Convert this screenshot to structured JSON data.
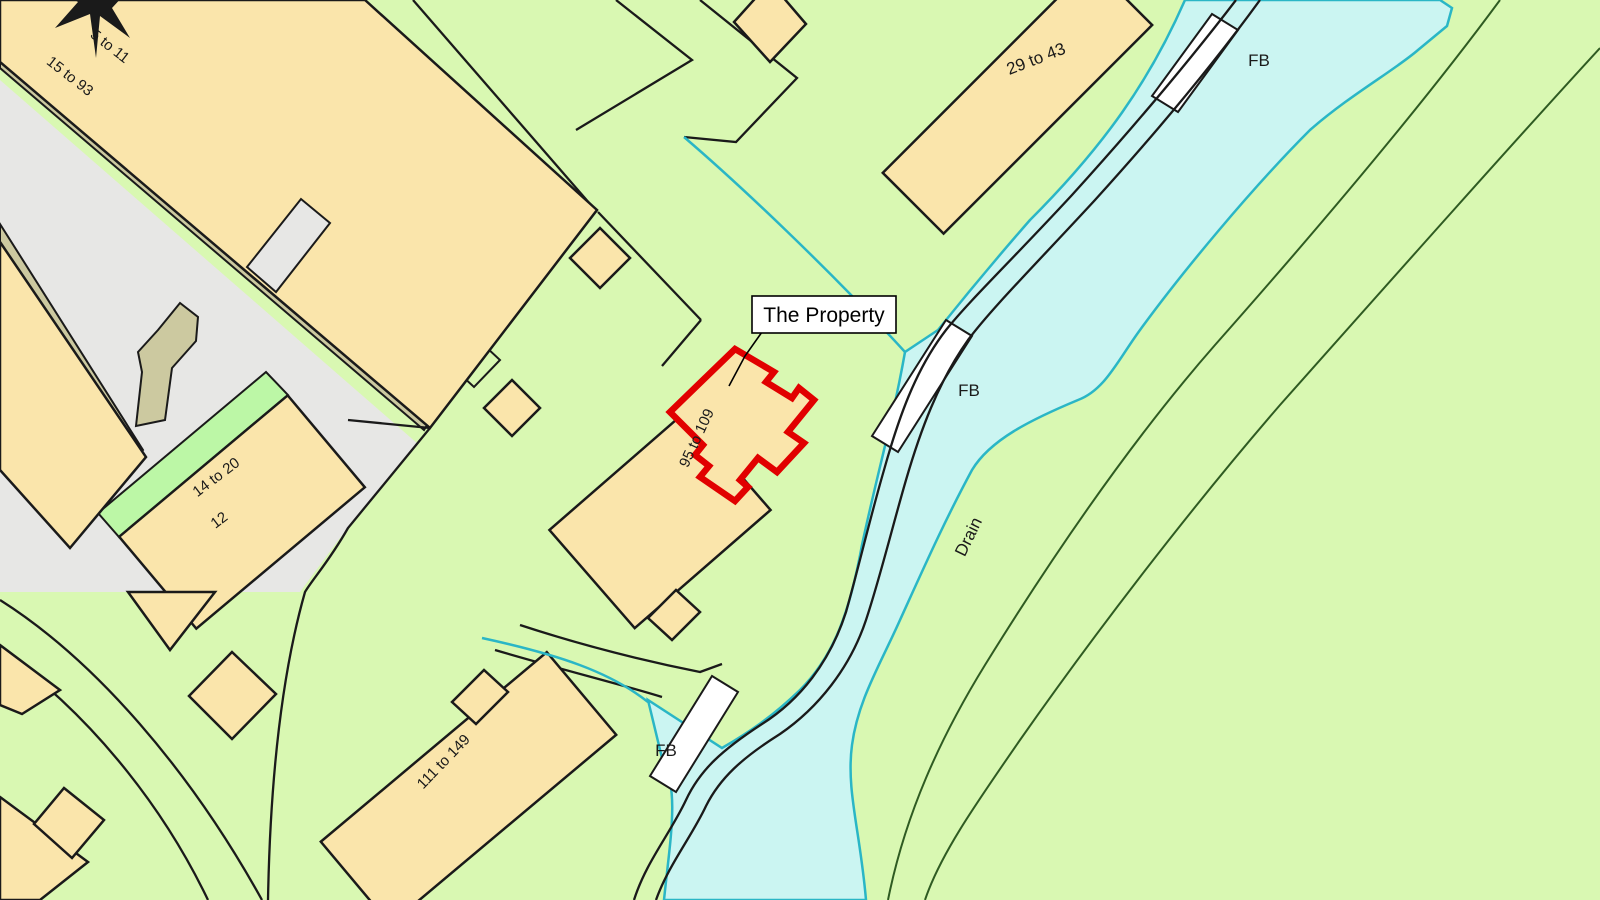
{
  "colors": {
    "background_green": "#D9F8B2",
    "bright_green": "#BCF7A6",
    "building_tan": "#FAE5AB",
    "road_gray": "#E7E7E5",
    "verge_olive": "#CCC9A0",
    "water_fill": "#CBF5F2",
    "water_line": "#2AB6C6",
    "path_dark_green": "#2F5B22",
    "outline_black": "#1A1A1A",
    "property_red": "#E10000",
    "label_white": "#FFFFFF"
  },
  "callout": {
    "text": "The Property"
  },
  "labels": {
    "range_5_11": "5 to 11",
    "range_15_93": "15 to 93",
    "range_29_43": "29 to 43",
    "range_95_109": "95 to 109",
    "range_14_20": "14 to 20",
    "number_12": "12",
    "range_111_149": "111 to 149",
    "drain": "Drain",
    "fb_top": "FB",
    "fb_middle": "FB",
    "fb_bottom": "FB"
  }
}
